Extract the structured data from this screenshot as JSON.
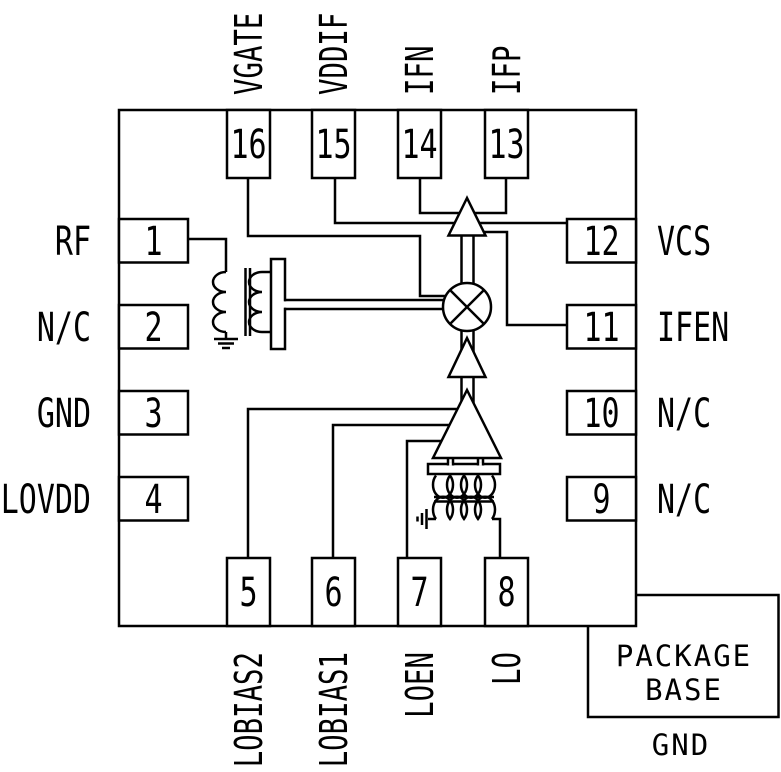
{
  "chip": {
    "pins": {
      "top": [
        {
          "number": "16",
          "name": "VGATE"
        },
        {
          "number": "15",
          "name": "VDDIF"
        },
        {
          "number": "14",
          "name": "IFN"
        },
        {
          "number": "13",
          "name": "IFP"
        }
      ],
      "bottom": [
        {
          "number": "5",
          "name": "LOBIAS2"
        },
        {
          "number": "6",
          "name": "LOBIAS1"
        },
        {
          "number": "7",
          "name": "LOEN"
        },
        {
          "number": "8",
          "name": "LO"
        }
      ],
      "left": [
        {
          "number": "1",
          "name": "RF"
        },
        {
          "number": "2",
          "name": "N/C"
        },
        {
          "number": "3",
          "name": "GND"
        },
        {
          "number": "4",
          "name": "LOVDD"
        }
      ],
      "right": [
        {
          "number": "12",
          "name": "VCS"
        },
        {
          "number": "11",
          "name": "IFEN"
        },
        {
          "number": "10",
          "name": "N/C"
        },
        {
          "number": "9",
          "name": "N/C"
        }
      ]
    },
    "package_base": {
      "line1": "PACKAGE",
      "line2": "BASE",
      "ground": "GND"
    },
    "symbols": [
      "rf-balun",
      "mixer",
      "if-amplifier",
      "lo-buffer-amplifier",
      "lo-amplifier",
      "lo-balun",
      "ground-symbol"
    ],
    "colors": {
      "line": "#000000",
      "background": "#ffffff"
    }
  }
}
